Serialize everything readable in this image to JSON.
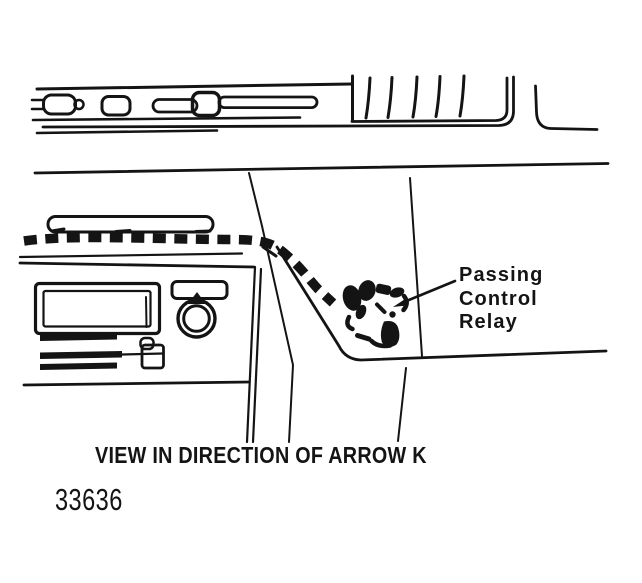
{
  "figure": {
    "callout": {
      "lines": [
        "Passing",
        "Control",
        "Relay"
      ]
    },
    "caption": "VIEW IN DIRECTION OF ARROW K",
    "figure_number": "33636",
    "colors": {
      "ink": "#141414",
      "paper": "#ffffff"
    }
  }
}
